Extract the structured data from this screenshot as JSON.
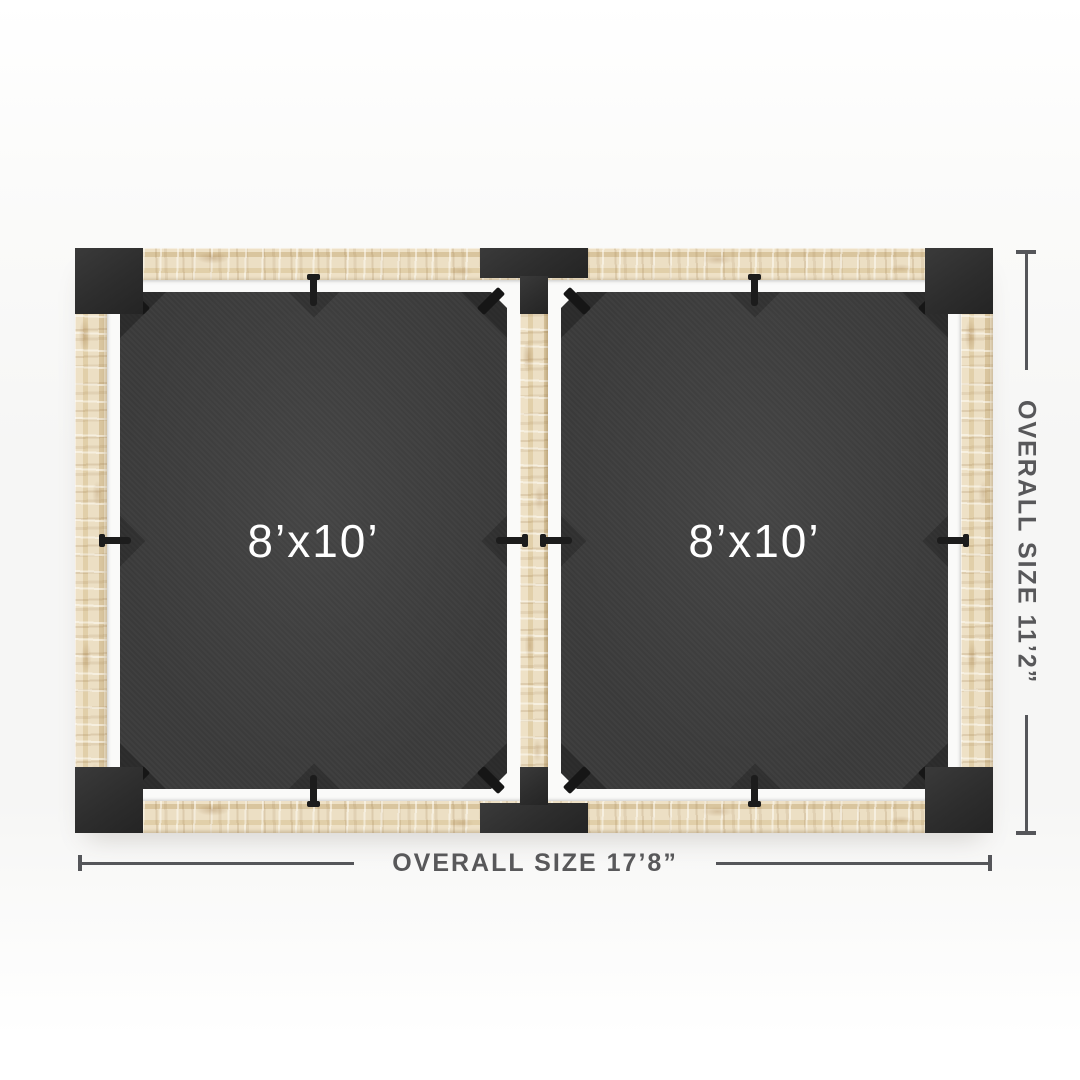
{
  "diagram": {
    "sails": [
      {
        "label": "8’x10’"
      },
      {
        "label": "8’x10’"
      }
    ],
    "dimensions": {
      "width": {
        "label": "OVERALL SIZE 17’8”"
      },
      "height": {
        "label": "OVERALL SIZE 11’2”"
      }
    },
    "colors": {
      "sail": "#3b3b3b",
      "bracket": "#2d2d2d",
      "wood": "#e8d9ba",
      "ledge": "#fafaf9",
      "dim_line": "#55565a",
      "dim_text": "#58585a",
      "sail_text": "#ffffff",
      "background": "#f6f6f5"
    }
  }
}
